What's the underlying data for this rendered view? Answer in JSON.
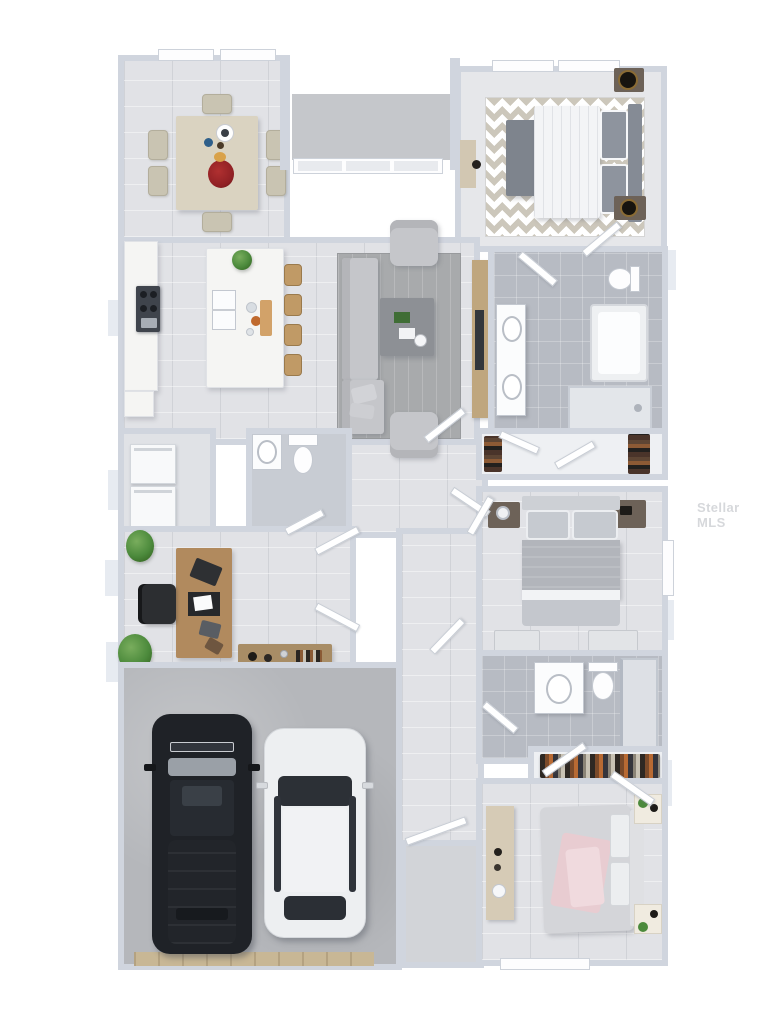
{
  "meta": {
    "description": "3D rendered top-down floor plan of a single-story 3-bedroom house with attached 2-car garage",
    "style": "photoreal dollhouse render on white background"
  },
  "watermark": {
    "text": "Stellar MLS"
  },
  "palette": {
    "wall": "#d0d5de",
    "wallLight": "#e7ebf1",
    "floorWood": "#e1e2e6",
    "floorTile": "#c9cdd4",
    "bathTile": "#b7bbc3",
    "closetFloor": "#eef0f3",
    "garageFloor": "#b5b7bb",
    "marble": "#f5f5f3",
    "stool": "#c09a66",
    "rugLiving": "#a8aaac",
    "sofa": "#c5c6ca",
    "coffeeTable": "#8d9095",
    "mediaWood": "#bfa67e",
    "tv": "#32363c",
    "chevronA": "#ccc7bb",
    "chevronB": "#ffffff",
    "bedWhite": "#f3f4f6",
    "pillowGray": "#8e949e",
    "headboard": "#858b95",
    "benchGray": "#7e848d",
    "nightstandDark": "#6d6258",
    "lampBlack": "#17140f",
    "diningTable": "#dad3c1",
    "diningChair": "#c9c4b2",
    "deskWood": "#b18a5e",
    "consoleWood": "#a88d66",
    "chairBlack": "#2c2e31",
    "plantGreen": "#4c8a3c",
    "washer": "#f8f9fa",
    "fixtureWhite": "#fbfcfd",
    "bed2Duvet": "#b2b5bb",
    "bed2Pillow": "#c6cad0",
    "bed3Duvet": "#d4d5d9",
    "bed3Pink": "#e8ccd1",
    "carBlack": "#1f2227",
    "carGlassDark": "#2c3036",
    "carWhite": "#edeff1",
    "windshieldSilver": "#9aa0a7",
    "garageDoor": "#c8b795",
    "porchSlab": "#c5c7cb",
    "window": "#fdfdfe",
    "door": "#ffffff",
    "watermark": "#b6b9bf"
  },
  "rooms": [
    {
      "name": "dining-room",
      "windows": 2,
      "furniture": [
        {
          "item": "dining-table",
          "count": 1
        },
        {
          "item": "dining-chair",
          "count": 6
        },
        {
          "item": "serving-bowl",
          "count": 1
        },
        {
          "item": "red-flower-centerpiece",
          "count": 1
        }
      ]
    },
    {
      "name": "entry-porch",
      "windows": 3,
      "furniture": [
        {
          "item": "concrete-slab",
          "count": 1
        }
      ]
    },
    {
      "name": "master-bedroom",
      "windows": 2,
      "furniture": [
        {
          "item": "bed-white-duvet",
          "count": 1
        },
        {
          "item": "chevron-rug",
          "count": 1
        },
        {
          "item": "foot-bench",
          "count": 1
        },
        {
          "item": "nightstand",
          "count": 2
        },
        {
          "item": "black-table-lamp",
          "count": 2
        },
        {
          "item": "vanity-desk",
          "count": 1
        }
      ]
    },
    {
      "name": "kitchen",
      "furniture": [
        {
          "item": "marble-island",
          "count": 1
        },
        {
          "item": "bar-stool",
          "count": 4
        },
        {
          "item": "double-sink",
          "count": 1
        },
        {
          "item": "range-cooktop",
          "count": 1
        },
        {
          "item": "perimeter-counter",
          "count": 1
        },
        {
          "item": "houseplant",
          "count": 1
        },
        {
          "item": "cutting-board",
          "count": 1
        }
      ]
    },
    {
      "name": "living-room",
      "furniture": [
        {
          "item": "sectional-sofa",
          "count": 1
        },
        {
          "item": "armchair",
          "count": 2
        },
        {
          "item": "coffee-table",
          "count": 1
        },
        {
          "item": "area-rug",
          "count": 1
        },
        {
          "item": "media-wall",
          "count": 1
        },
        {
          "item": "tv",
          "count": 1
        }
      ]
    },
    {
      "name": "master-bathroom",
      "furniture": [
        {
          "item": "double-vanity",
          "count": 1
        },
        {
          "item": "bathtub",
          "count": 1
        },
        {
          "item": "walk-in-shower",
          "count": 1
        },
        {
          "item": "toilet",
          "count": 1
        }
      ]
    },
    {
      "name": "master-closet",
      "furniture": [
        {
          "item": "shoe-shelf",
          "count": 2
        }
      ]
    },
    {
      "name": "laundry-room",
      "furniture": [
        {
          "item": "washer",
          "count": 1
        },
        {
          "item": "dryer",
          "count": 1
        }
      ]
    },
    {
      "name": "powder-room",
      "furniture": [
        {
          "item": "vanity-sink",
          "count": 1
        },
        {
          "item": "toilet",
          "count": 1
        }
      ]
    },
    {
      "name": "office",
      "furniture": [
        {
          "item": "desk",
          "count": 1
        },
        {
          "item": "office-chair",
          "count": 1
        },
        {
          "item": "laptop",
          "count": 1
        },
        {
          "item": "console-table",
          "count": 1
        },
        {
          "item": "houseplant",
          "count": 2
        },
        {
          "item": "french-door",
          "count": 2
        }
      ]
    },
    {
      "name": "garage",
      "furniture": [
        {
          "item": "black-suv",
          "count": 1
        },
        {
          "item": "white-sedan",
          "count": 1
        },
        {
          "item": "garage-door",
          "count": 1
        }
      ]
    },
    {
      "name": "bedroom-2",
      "furniture": [
        {
          "item": "bed-gray-duvet",
          "count": 1
        },
        {
          "item": "nightstand",
          "count": 2
        },
        {
          "item": "foot-stool",
          "count": 2
        }
      ]
    },
    {
      "name": "bathroom-2",
      "furniture": [
        {
          "item": "vanity-sink",
          "count": 1
        },
        {
          "item": "toilet",
          "count": 1
        },
        {
          "item": "shower",
          "count": 1
        }
      ]
    },
    {
      "name": "hall-closet",
      "furniture": [
        {
          "item": "hanging-clothes-rod",
          "count": 1
        }
      ]
    },
    {
      "name": "bedroom-3",
      "furniture": [
        {
          "item": "bed-pink-throw",
          "count": 1
        },
        {
          "item": "nightstand",
          "count": 2
        },
        {
          "item": "dresser",
          "count": 1
        }
      ],
      "windows": 1
    },
    {
      "name": "entry-hall",
      "furniture": [
        {
          "item": "interior-door",
          "count": 1
        }
      ]
    }
  ]
}
